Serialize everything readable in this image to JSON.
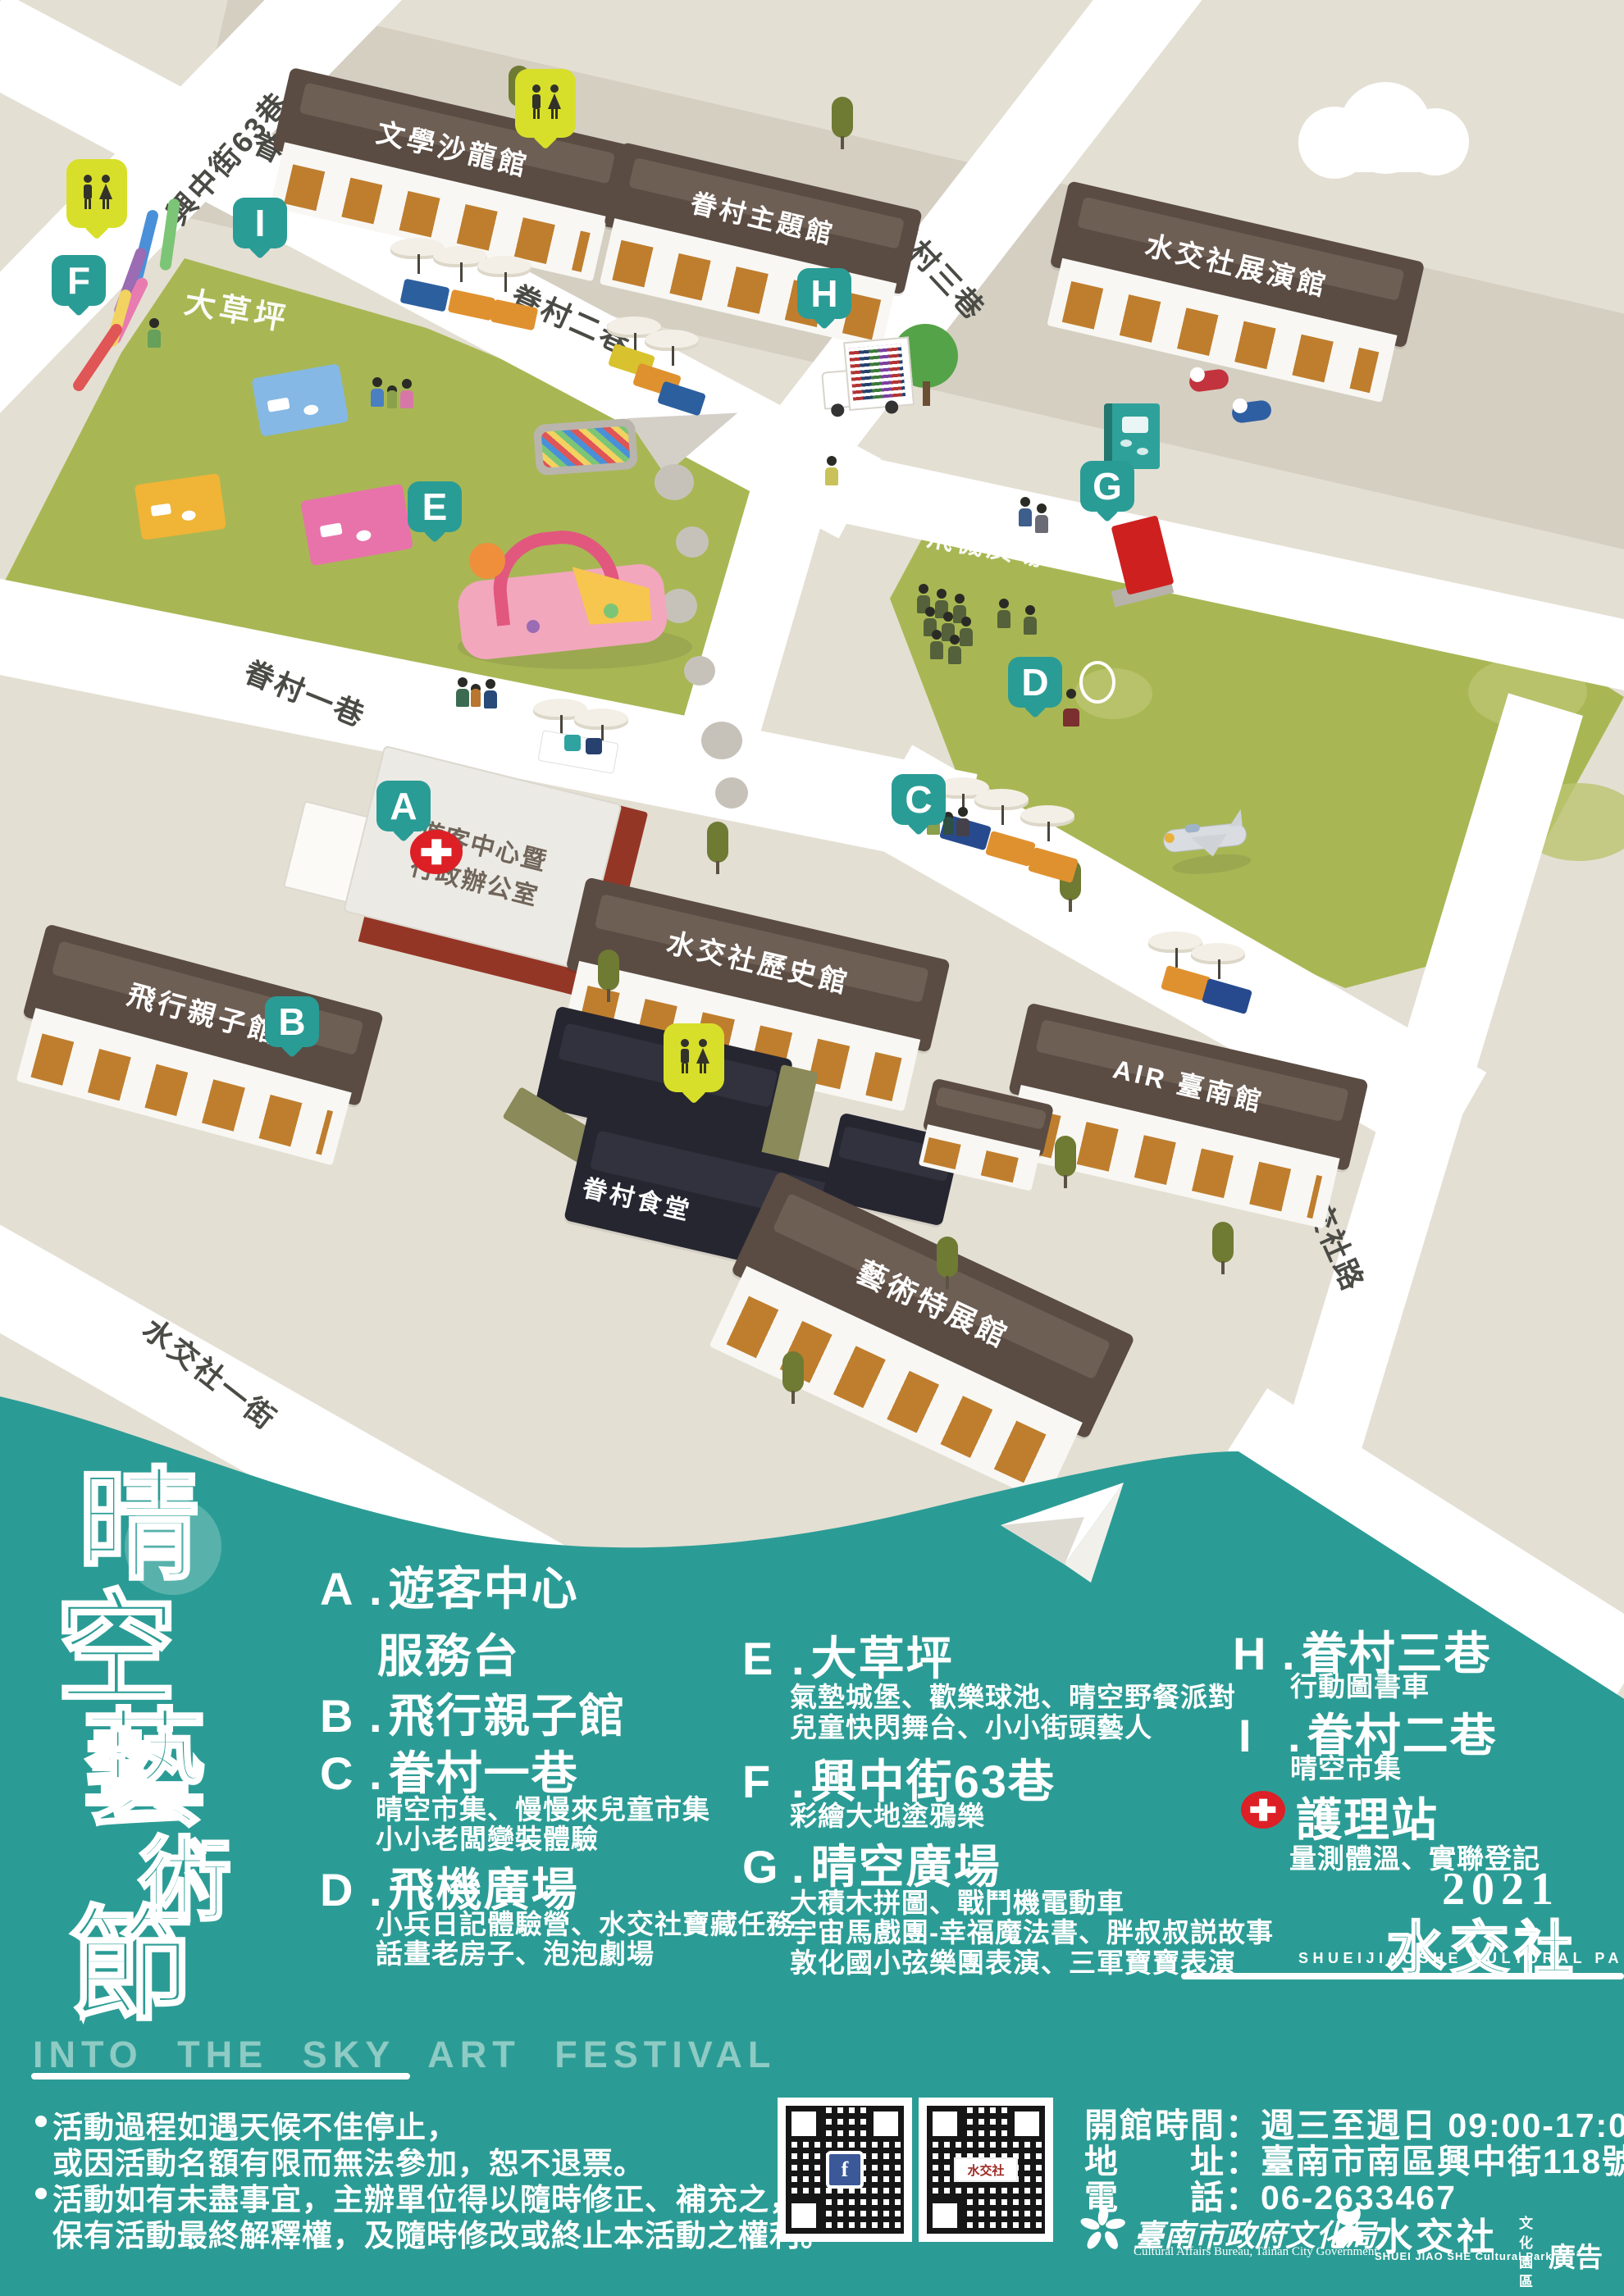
{
  "map": {
    "streets": [
      "興中街63巷",
      "眷村二巷",
      "眷村三巷",
      "眷村二巷",
      "眷村一巷",
      "水交社一街",
      "水交社路"
    ],
    "areas": [
      "大草坪",
      "飛機廣場"
    ],
    "buildings": [
      "文學沙龍館",
      "眷村主題館",
      "水交社展演館",
      "遊客中心暨",
      "行政辦公室",
      "飛行親子館",
      "水交社歷史館",
      "眷村食堂",
      "AIR 臺南館",
      "藝術特展館"
    ],
    "pins": [
      "A",
      "B",
      "C",
      "D",
      "E",
      "F",
      "G",
      "H",
      "I"
    ]
  },
  "legend": {
    "separator": ".",
    "items": [
      {
        "letter": "A",
        "title": "遊客中心",
        "sub": "服務台",
        "details": []
      },
      {
        "letter": "B",
        "title": "飛行親子館",
        "details": []
      },
      {
        "letter": "C",
        "title": "眷村一巷",
        "details": [
          "晴空市集、慢慢來兒童市集",
          "小小老闆變裝體驗"
        ]
      },
      {
        "letter": "D",
        "title": "飛機廣場",
        "details": [
          "小兵日記體驗營、水交社寶藏任務",
          "話畫老房子、泡泡劇場"
        ]
      },
      {
        "letter": "E",
        "title": "大草坪",
        "details": [
          "氣墊城堡、歡樂球池、晴空野餐派對",
          "兒童快閃舞台、小小街頭藝人"
        ]
      },
      {
        "letter": "F",
        "title": "興中街63巷",
        "details": [
          "彩繪大地塗鴉樂"
        ]
      },
      {
        "letter": "G",
        "title": "晴空廣場",
        "details": [
          "大積木拼圖、戰鬥機電動車",
          "宇宙馬戲團-幸福魔法書、胖叔叔説故事",
          "敦化國小弦樂團表演、三軍寶寶表演"
        ]
      },
      {
        "letter": "H",
        "title": "眷村三巷",
        "details": [
          "行動圖書車"
        ]
      },
      {
        "letter": "I",
        "title": "眷村二巷",
        "details": [
          "晴空市集"
        ]
      }
    ],
    "nursing": {
      "title": "護理站",
      "detail": "量測體溫、實聯登記"
    }
  },
  "branding": {
    "festival_vertical": "晴空藝術節",
    "festival_en": "INTO THE SKY ART FESTIVAL",
    "year": "2021",
    "park_zh": "水交社",
    "park_en": "SHUEIJIAOSHE CULTURAL PARK"
  },
  "notes": [
    "活動過程如遇天候不佳停止，",
    "或因活動名額有限而無法參加，恕不退票。",
    "活動如有未盡事宜，主辦單位得以隨時修正、補充之，",
    "保有活動最終解釋權，及隨時修改或終止本活動之權利。"
  ],
  "footer": {
    "hours_label": "開館時間：",
    "hours_value": "週三至週日 09:00-17:00",
    "address_label": "地　　址：",
    "address_value": "臺南市南區興中街118號",
    "phone_label": "電　　話：",
    "phone_value": "06-2633467",
    "bureau_zh": "臺南市政府文化局",
    "bureau_en": "Cultural Affairs Bureau, Tainan City Government",
    "park_logo_zh": "水交社",
    "park_logo_en": "SHUEI JIAO SHE Cultural Park",
    "park_logo_side": "文化園區",
    "ad": "廣告",
    "fb": "f"
  }
}
